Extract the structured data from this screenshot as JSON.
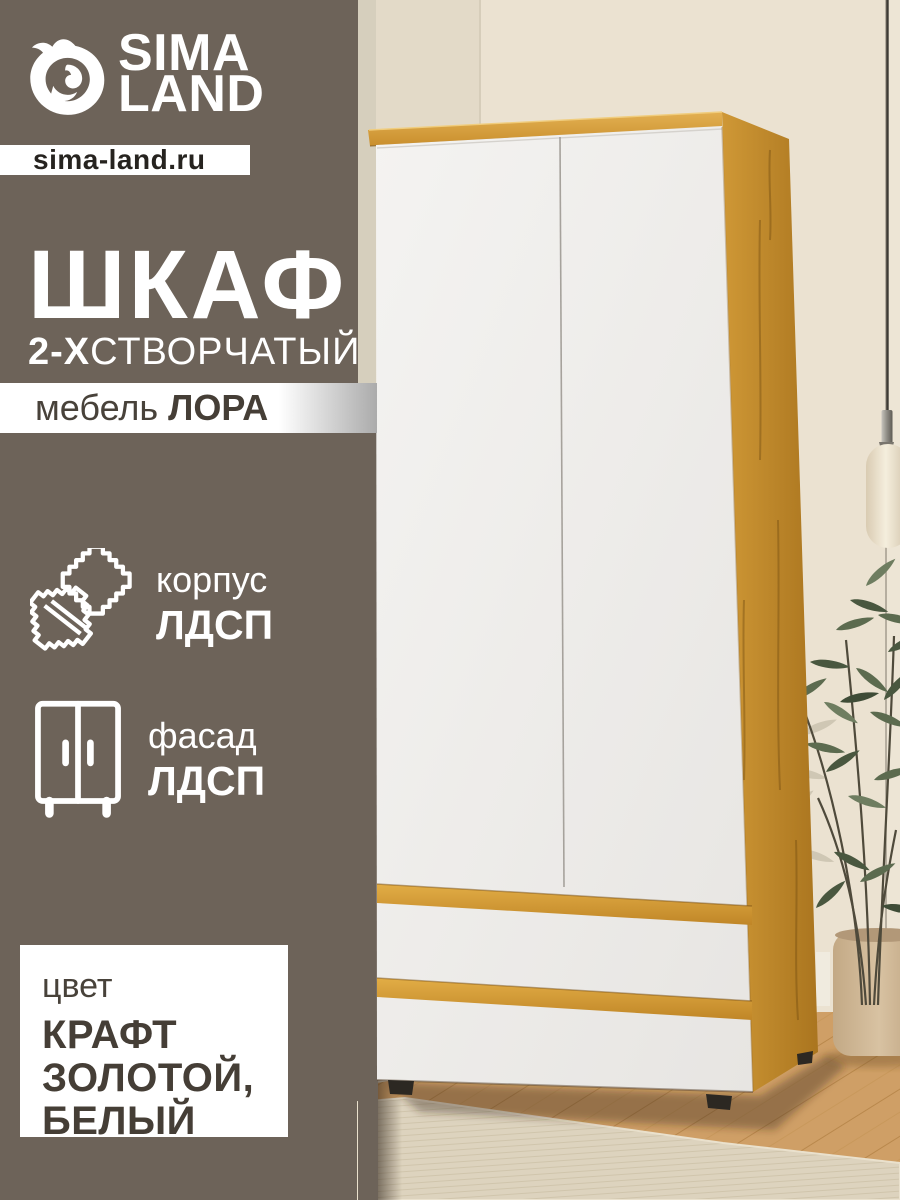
{
  "branding": {
    "logo_line1": "SIMA",
    "logo_line2": "LAND",
    "website": "sima-land.ru"
  },
  "title": {
    "main": "ШКАФ",
    "sub_bold": "2-Х",
    "sub_rest": "СТВОРЧАТЫЙ",
    "collection_prefix": "мебель ",
    "collection_name": "ЛОРА"
  },
  "features": [
    {
      "icon": "material-swatch-icon",
      "label": "корпус",
      "value": "ЛДСП"
    },
    {
      "icon": "wardrobe-icon",
      "label": "фасад",
      "value": "ЛДСП"
    }
  ],
  "color_spec": {
    "label": "цвет",
    "lines": [
      "КРАФТ",
      "ЗОЛОТОЙ,",
      "БЕЛЫЙ"
    ]
  },
  "colors": {
    "background_panel": "#6d6359",
    "bar_background": "#ffffff",
    "title_text": "#ffffff",
    "dark_text": "#453e36",
    "accent_wood": "#cd9434",
    "door_white": "#f0efed",
    "wall": "#ebe2d1",
    "floor": "#cf9f66",
    "rug": "#ddd3be",
    "plant_green": "#5c6b4f"
  }
}
